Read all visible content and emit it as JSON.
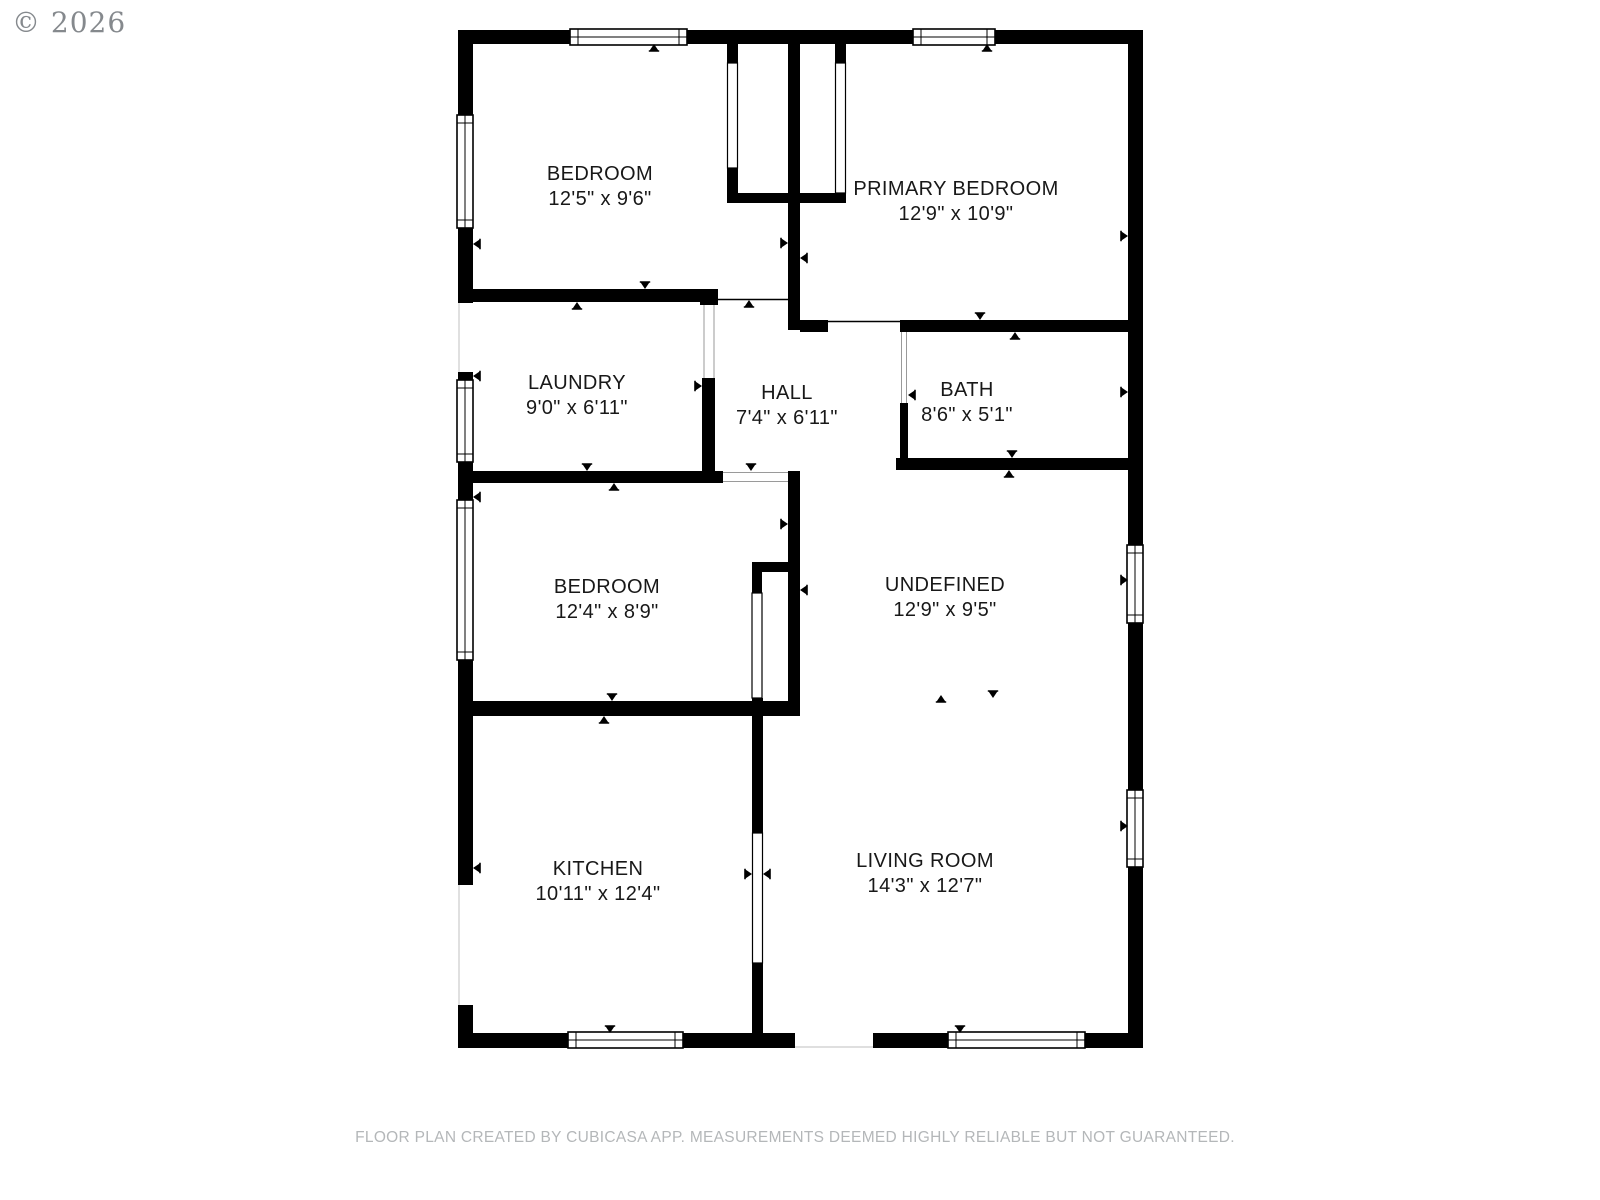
{
  "watermark": "© 2026",
  "footer": "FLOOR PLAN CREATED BY CUBICASA APP. MEASUREMENTS DEEMED HIGHLY RELIABLE BUT NOT GUARANTEED.",
  "colors": {
    "wall": "#000000",
    "label": "#181818",
    "watermark": "#85898d",
    "footer": "#b4b7b9"
  },
  "rooms": [
    {
      "name": "BEDROOM",
      "dims": "12'5\" x 9'6\""
    },
    {
      "name": "PRIMARY BEDROOM",
      "dims": "12'9\" x 10'9\""
    },
    {
      "name": "LAUNDRY",
      "dims": "9'0\" x 6'11\""
    },
    {
      "name": "HALL",
      "dims": "7'4\" x 6'11\""
    },
    {
      "name": "BATH",
      "dims": "8'6\" x 5'1\""
    },
    {
      "name": "BEDROOM",
      "dims": "12'4\" x 8'9\""
    },
    {
      "name": "UNDEFINED",
      "dims": "12'9\" x 9'5\""
    },
    {
      "name": "KITCHEN",
      "dims": "10'11\" x 12'4\""
    },
    {
      "name": "LIVING ROOM",
      "dims": "14'3\" x 12'7\""
    }
  ]
}
